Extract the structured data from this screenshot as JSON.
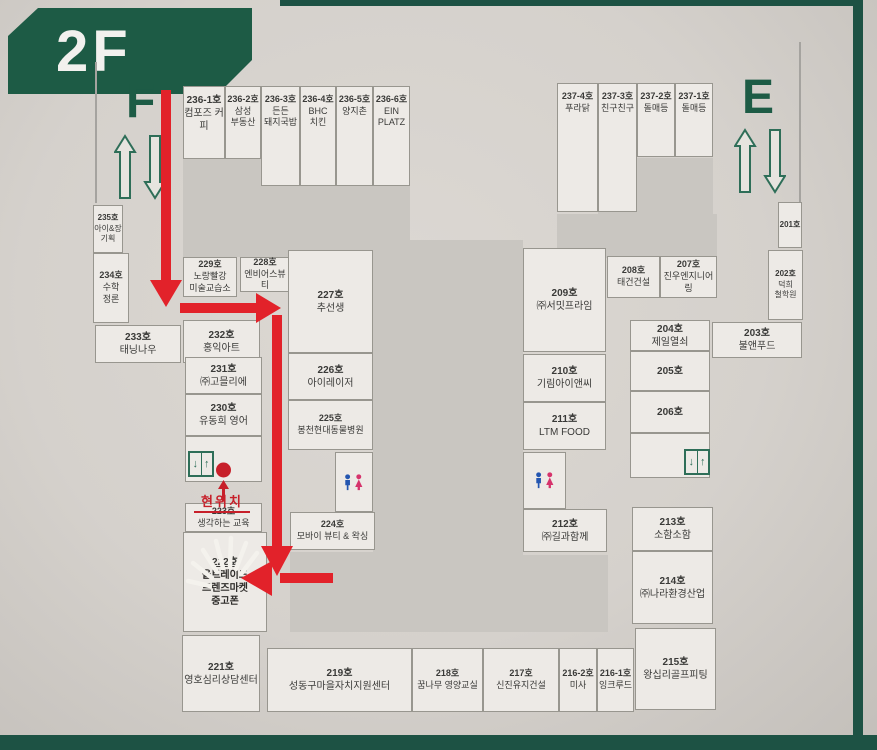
{
  "floor": {
    "label": "2F"
  },
  "stairs": {
    "left_letter": "F",
    "right_letter": "E"
  },
  "current_location": {
    "label": "현위치"
  },
  "elevator": {
    "down_glyph": "↓",
    "up_glyph": "↑"
  },
  "colors": {
    "accent_green": "#1d5b45",
    "path_red": "#e2222a",
    "location_red": "#c7202a",
    "restroom_male_blue": "#2456b0",
    "restroom_female_pink": "#d6336c"
  },
  "rooms": {
    "r236_1": {
      "no": "236-1호",
      "name": "컴포즈 커피"
    },
    "r236_2": {
      "no": "236-2호",
      "name": "삼성\n부동산"
    },
    "r236_3": {
      "no": "236-3호",
      "name": "든든\n돼지국밥"
    },
    "r236_4": {
      "no": "236-4호",
      "name": "BHC\n치킨"
    },
    "r236_5": {
      "no": "236-5호",
      "name": "양지촌"
    },
    "r236_6": {
      "no": "236-6호",
      "name": "EIN\nPLATZ"
    },
    "r237_4": {
      "no": "237-4호",
      "name": "푸라닭"
    },
    "r237_3": {
      "no": "237-3호",
      "name": "친구친구"
    },
    "r237_2": {
      "no": "237-2호",
      "name": "돌매등"
    },
    "r237_1": {
      "no": "237-1호",
      "name": "돌매등"
    },
    "r235": {
      "no": "235호",
      "name": "아이&장\n기획"
    },
    "r234": {
      "no": "234호",
      "name": "수학\n정론"
    },
    "r233": {
      "no": "233호",
      "name": "태닝나우"
    },
    "r232": {
      "no": "232호",
      "name": "홍익아트"
    },
    "r231": {
      "no": "231호",
      "name": "㈜고믈리에"
    },
    "r230": {
      "no": "230호",
      "name": "유동희 영어"
    },
    "r229": {
      "no": "229호",
      "name": "노랑빨강\n미술교습소"
    },
    "r228": {
      "no": "228호",
      "name": "엔비어스뷰티"
    },
    "r227": {
      "no": "227호",
      "name": "추선생"
    },
    "r226": {
      "no": "226호",
      "name": "아이레이저"
    },
    "r225": {
      "no": "225호",
      "name": "봉천현대동물병원"
    },
    "r224": {
      "no": "224호",
      "name": "모바이 뷰티 & 왁싱"
    },
    "r223": {
      "no": "223호",
      "name": "생각하는 교육"
    },
    "r222": {
      "no": "222호",
      "name": "올트레이드\n프렌즈마켓\n중고폰"
    },
    "r221": {
      "no": "221호",
      "name": "영호심리상담센터"
    },
    "r219": {
      "no": "219호",
      "name": "성동구마을자치지원센터"
    },
    "r218": {
      "no": "218호",
      "name": "꿈나무 영양교실"
    },
    "r217": {
      "no": "217호",
      "name": "신진유지건설"
    },
    "r216_2": {
      "no": "216-2호",
      "name": "미사"
    },
    "r216_1": {
      "no": "216-1호",
      "name": "잉크루드"
    },
    "r215": {
      "no": "215호",
      "name": "왕십리골프피팅"
    },
    "r214": {
      "no": "214호",
      "name": "㈜나라환경산업"
    },
    "r213": {
      "no": "213호",
      "name": "소함소함"
    },
    "r212": {
      "no": "212호",
      "name": "㈜길과함께"
    },
    "r211": {
      "no": "211호",
      "name": "LTM FOOD"
    },
    "r210": {
      "no": "210호",
      "name": "기림아이앤씨"
    },
    "r209": {
      "no": "209호",
      "name": "㈜서밋프라임"
    },
    "r208": {
      "no": "208호",
      "name": "태건건설"
    },
    "r207": {
      "no": "207호",
      "name": "진우엔지니어링"
    },
    "r206": {
      "no": "206호",
      "name": ""
    },
    "r205": {
      "no": "205호",
      "name": ""
    },
    "r204": {
      "no": "204호",
      "name": "제일열쇠"
    },
    "r203": {
      "no": "203호",
      "name": "불앤푸드"
    },
    "r202": {
      "no": "202호",
      "name": "덕희\n철학원"
    },
    "r201": {
      "no": "201호",
      "name": ""
    }
  }
}
